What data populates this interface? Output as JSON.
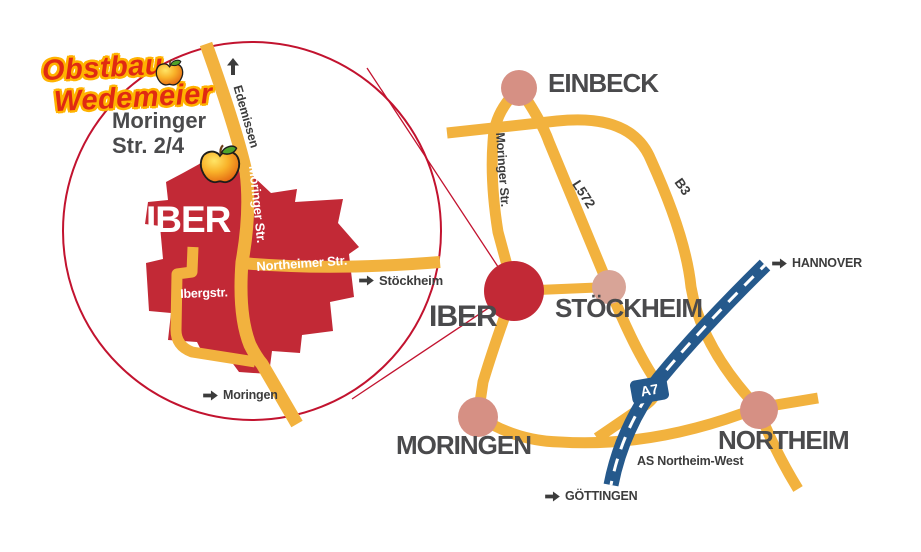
{
  "colors": {
    "road_yellow": "#F2B23E",
    "area_red": "#C22936",
    "outline_red": "#C2132F",
    "town_pink": "#D69084",
    "town_pink_light": "#D8A497",
    "autobahn_blue": "#25598C",
    "city_label_gray": "#4A4A4C",
    "small_label_dark": "#3C3C3C",
    "logo_red": "#E02A12",
    "logo_outline_yellow": "#FFB300"
  },
  "logo": {
    "line1": "Obstbau",
    "line2": "Wedemeier"
  },
  "address": {
    "line1": "Moringer",
    "line2": "Str. 2/4"
  },
  "inset": {
    "area_label": "IBER",
    "streets": {
      "moringer": "Moringer Str.",
      "northeimer": "Northeimer Str.",
      "ibergstr": "Ibergstr."
    },
    "directions": {
      "edemissen": "Edemissen",
      "moringen": "Moringen",
      "stockheim": "Stöckheim"
    }
  },
  "map": {
    "cities": {
      "einbeck": "EINBECK",
      "stockheim": "STÖCKHEIM",
      "iber": "IBER",
      "moringen": "MORINGEN",
      "northeim": "NORTHEIM"
    },
    "roads": {
      "moringer": "Moringer Str.",
      "l572": "L572",
      "b3": "B3",
      "a7_badge": "A7"
    },
    "directions": {
      "hannover": "HANNOVER",
      "goettingen": "GÖTTINGEN"
    },
    "junction_label": "AS Northeim-West"
  }
}
